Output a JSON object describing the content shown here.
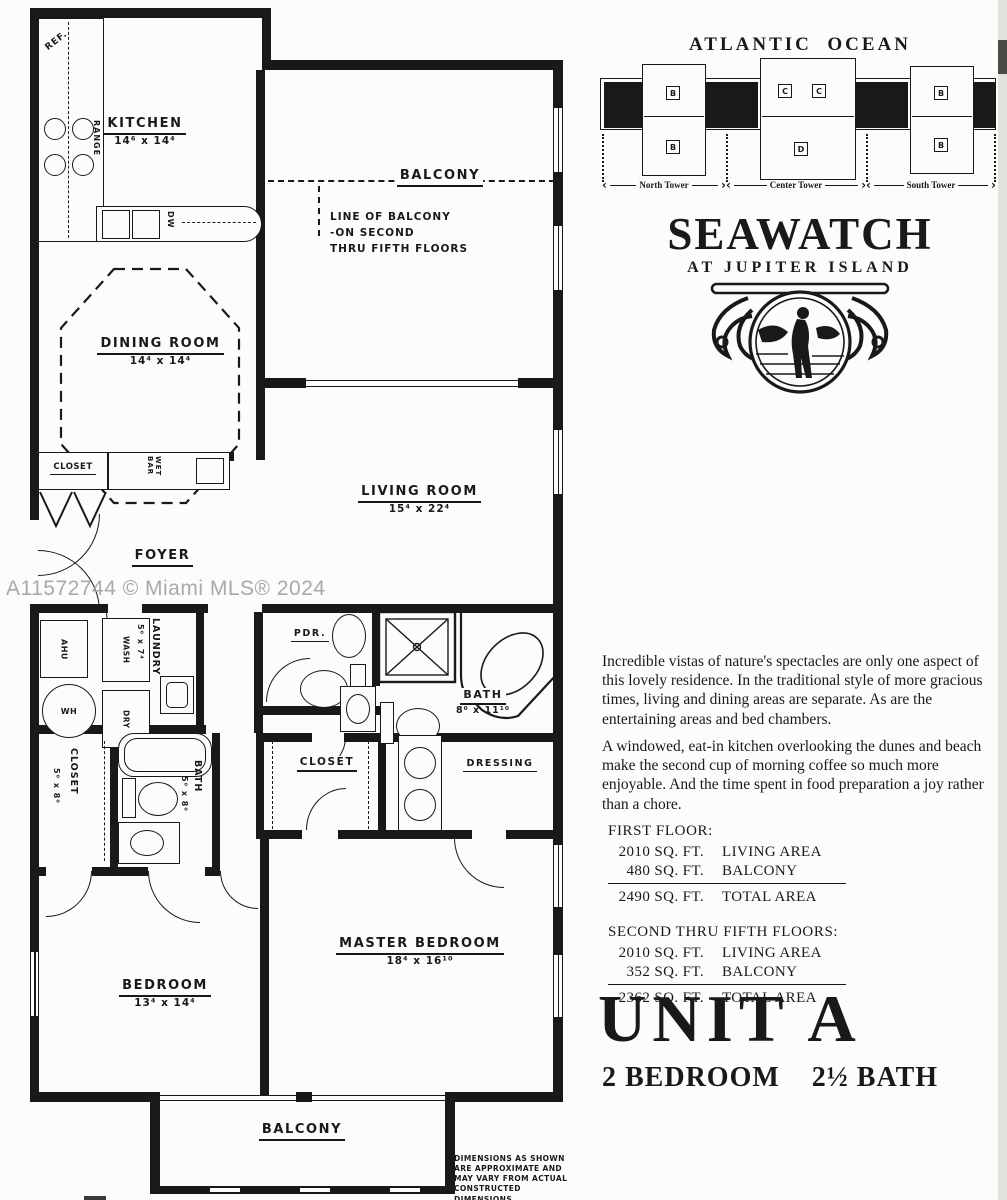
{
  "watermark": "A11572744 © Miami MLS® 2024",
  "site_plan": {
    "title": "ATLANTIC  OCEAN",
    "towers": [
      {
        "label": "North Tower",
        "top": "B",
        "bottom": "B"
      },
      {
        "label": "Center Tower",
        "top_left": "C",
        "top_right": "C",
        "bottom": "D"
      },
      {
        "label": "South Tower",
        "top": "B",
        "bottom": "B"
      }
    ]
  },
  "brand": {
    "name": "SEAWATCH",
    "tagline": "AT JUPITER ISLAND"
  },
  "description": {
    "p1": "Incredible vistas of nature's spectacles are only one aspect of this lovely residence. In the traditional style of more gracious times, living and dining areas are separate. As are the entertaining areas and bed chambers.",
    "p2": "A windowed, eat-in kitchen overlooking the dunes and beach make the second cup of morning coffee so much more enjoyable. And the time spent in food preparation a joy rather than a chore."
  },
  "areas": {
    "first_floor": {
      "title": "FIRST FLOOR:",
      "rows": [
        {
          "sqft": "2010 SQ. FT.",
          "label": "LIVING AREA"
        },
        {
          "sqft": "480 SQ. FT.",
          "label": "BALCONY"
        }
      ],
      "total": {
        "sqft": "2490 SQ. FT.",
        "label": "TOTAL AREA"
      }
    },
    "upper_floors": {
      "title": "SECOND THRU FIFTH FLOORS:",
      "rows": [
        {
          "sqft": "2010 SQ. FT.",
          "label": "LIVING AREA"
        },
        {
          "sqft": "352 SQ. FT.",
          "label": "BALCONY"
        }
      ],
      "total": {
        "sqft": "2362 SQ. FT.",
        "label": "TOTAL AREA"
      }
    }
  },
  "unit": {
    "title": "UNIT A",
    "bed": "2 BEDROOM",
    "bath": "2½ BATH"
  },
  "disclaimer": "DIMENSIONS AS SHOWN\nARE APPROXIMATE AND\nMAY VARY FROM ACTUAL\nCONSTRUCTED DIMENSIONS",
  "plan": {
    "kitchen": {
      "label": "KITCHEN",
      "dim": "14⁶ x 14⁴"
    },
    "balcony_upper": {
      "label": "BALCONY"
    },
    "balcony_note": "LINE OF BALCONY\n-ON SECOND\nTHRU FIFTH FLOORS",
    "dining": {
      "label": "DINING ROOM",
      "dim": "14⁴ x 14⁴"
    },
    "living": {
      "label": "LIVING ROOM",
      "dim": "15⁴ x 22⁴"
    },
    "foyer": {
      "label": "FOYER"
    },
    "closet_foyer": {
      "label": "CLOSET"
    },
    "wet_bar": {
      "label": "WET BAR"
    },
    "ref": "REF.",
    "range": "RANGE",
    "dw": "DW",
    "laundry": {
      "label": "LAUNDRY",
      "dim": "5⁰ x 7⁴"
    },
    "ahu": "AHU",
    "wh": "WH",
    "wash": "WASH",
    "dry": "DRY",
    "pdr": {
      "label": "PDR."
    },
    "bath_master": {
      "label": "BATH",
      "dim": "8⁰ x 11¹⁰"
    },
    "dressing": {
      "label": "DRESSING"
    },
    "closet_master": {
      "label": "CLOSET"
    },
    "closet_hall": {
      "label": "CLOSET",
      "dim": "5⁰ x 8⁰"
    },
    "bath_hall": {
      "label": "BATH",
      "dim": "5⁰ x 8⁰"
    },
    "bedroom": {
      "label": "BEDROOM",
      "dim": "13⁴ x 14⁴"
    },
    "master_bedroom": {
      "label": "MASTER BEDROOM",
      "dim": "18⁴ x 16¹⁰"
    },
    "balcony_lower": {
      "label": "BALCONY"
    }
  }
}
